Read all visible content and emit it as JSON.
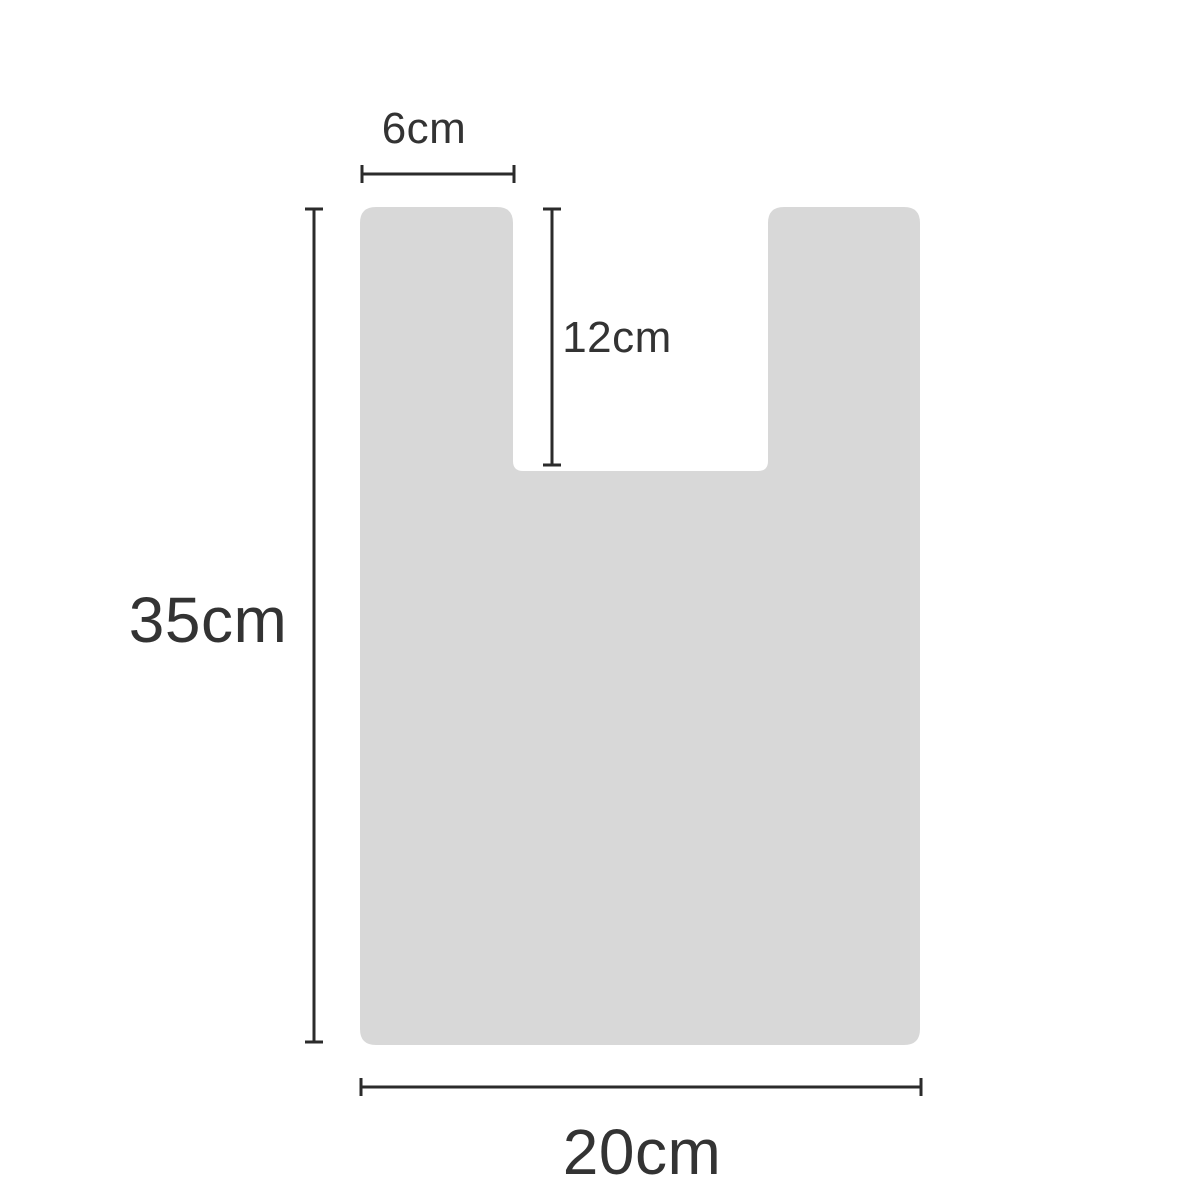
{
  "diagram": {
    "title": "bag-dimension-diagram",
    "background_color": "#ffffff",
    "shape": {
      "name": "t-shirt-bag-silhouette",
      "fill": "#d8d8d8"
    },
    "line_color": "#2b2b2b",
    "text_color": "#333333",
    "dimensions": {
      "handle_width": {
        "label": "6cm"
      },
      "notch_depth": {
        "label": "12cm"
      },
      "bag_height": {
        "label": "35cm"
      },
      "bag_width": {
        "label": "20cm"
      }
    }
  }
}
